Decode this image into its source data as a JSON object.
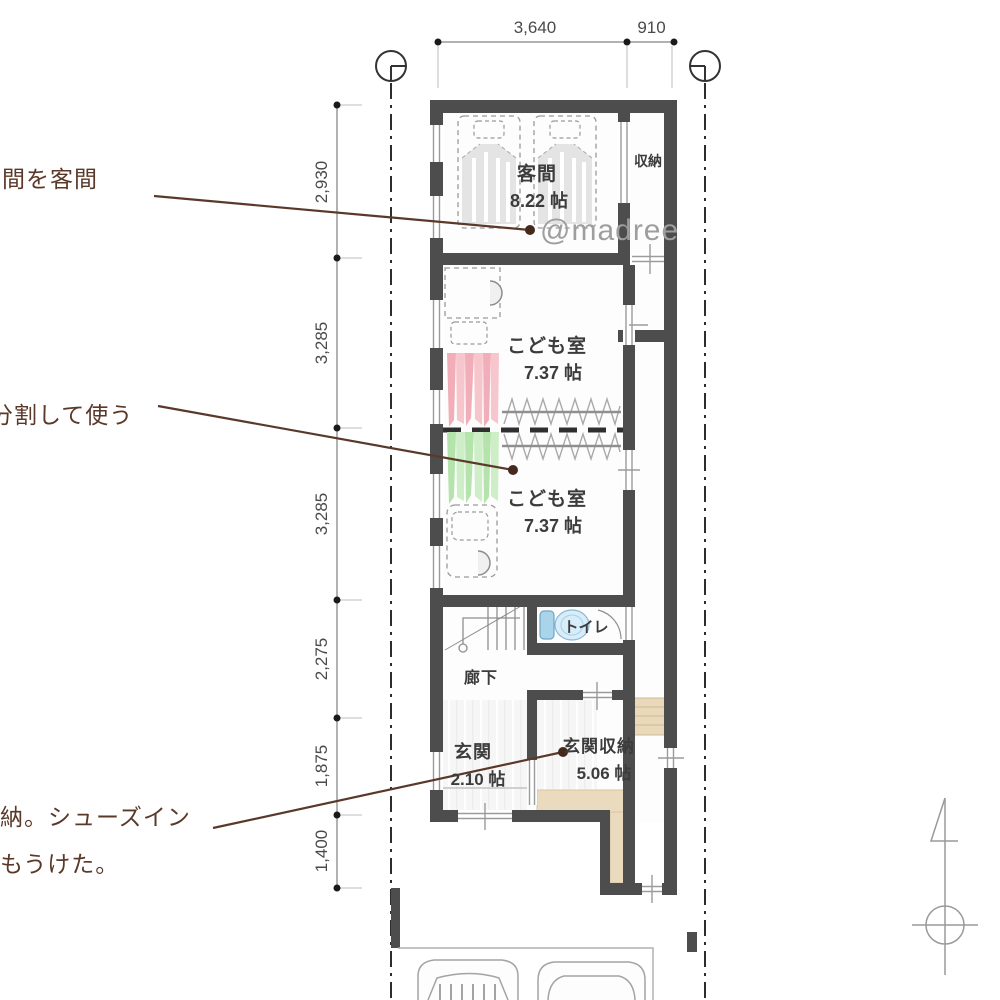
{
  "watermark": "@madree",
  "dims": {
    "top": {
      "d1": "3,640",
      "d2": "910"
    },
    "left": {
      "d1": "2,930",
      "d2": "3,285",
      "d3": "3,285",
      "d4": "2,275",
      "d5": "1,875",
      "d6": "1,400"
    }
  },
  "rooms": {
    "kyakuma": {
      "name": "客間",
      "size": "8.22 帖"
    },
    "shuno": {
      "name": "収納"
    },
    "kodomo1": {
      "name": "こども室",
      "size": "7.37 帖"
    },
    "kodomo2": {
      "name": "こども室",
      "size": "7.37 帖"
    },
    "toilet": {
      "name": "トイレ"
    },
    "rouka": {
      "name": "廊下"
    },
    "genkan": {
      "name": "玄関",
      "size": "2.10 帖"
    },
    "genkan_shuno": {
      "name": "玄関収納",
      "size": "5.06 帖"
    }
  },
  "annotations": {
    "a1": "間を客間",
    "a2": "分割して使う",
    "a3_line1": "納。シューズイン",
    "a3_line2": "もうけた。"
  },
  "colors": {
    "wall": "#4d4d4d",
    "annotation_brown": "#5a392a",
    "tatami_beige": "#eadbbf",
    "clothes_pink": "#f2aeb8",
    "clothes_green": "#b4e3ab",
    "toilet_blue": "#cfe8f6",
    "watermark_gray": "#9e9e9e"
  }
}
